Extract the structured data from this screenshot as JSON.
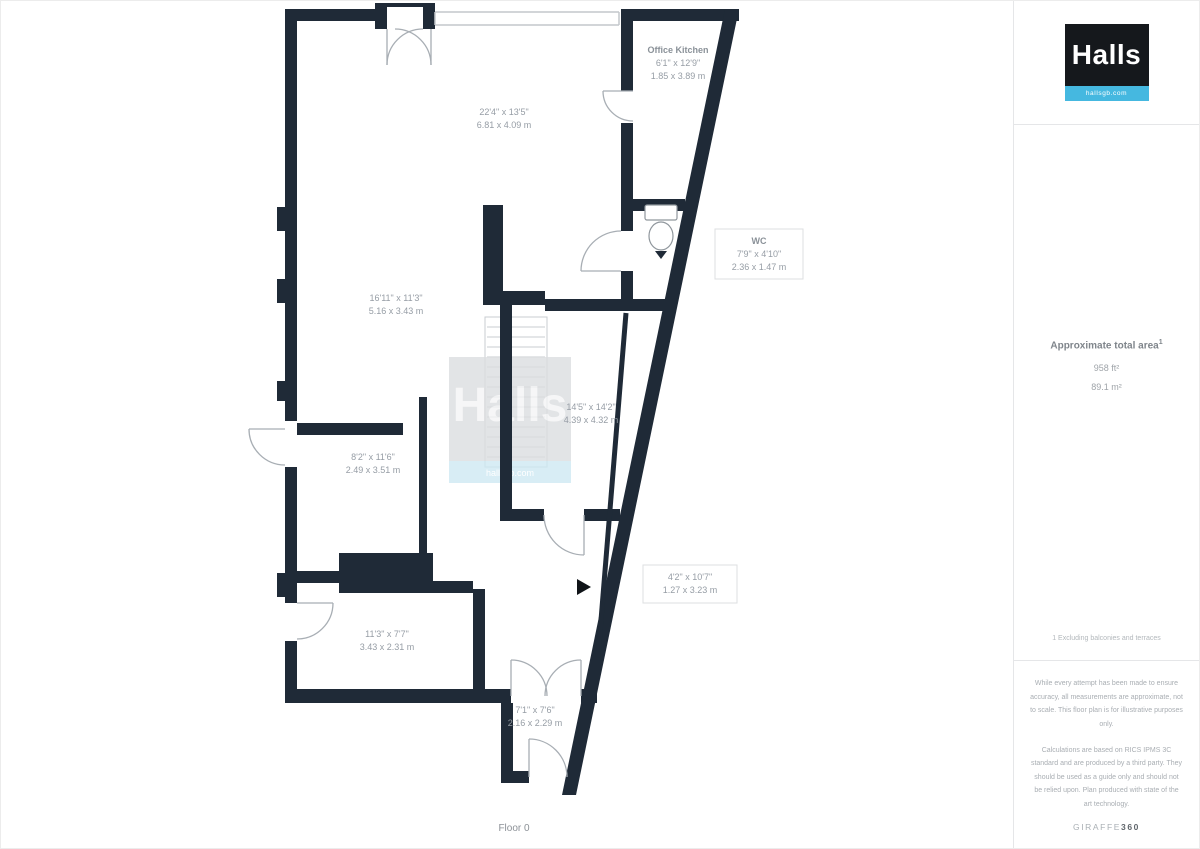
{
  "branding": {
    "logo_text": "Halls",
    "logo_tagline": "hallsgb.com"
  },
  "watermark": {
    "text": "Halls",
    "tagline": "hallsgb.com"
  },
  "plan": {
    "floor_label": "Floor 0",
    "rooms": {
      "top_middle": {
        "imperial": "22'4\" x 13'5\"",
        "metric": "6.81 x 4.09 m"
      },
      "office_kitchen": {
        "name": "Office Kitchen",
        "imperial": "6'1\" x 12'9\"",
        "metric": "1.85 x 3.89 m"
      },
      "wc": {
        "name": "WC",
        "imperial": "7'9\" x 4'10\"",
        "metric": "2.36 x 1.47 m"
      },
      "left": {
        "imperial": "16'11\" x 11'3\"",
        "metric": "5.16 x 3.43 m"
      },
      "stairwell": {
        "imperial": "14'5\" x 14'2\"",
        "metric": "4.39 x 4.32 m"
      },
      "mid_left": {
        "imperial": "8'2\" x 11'6\"",
        "metric": "2.49 x 3.51 m"
      },
      "bottom_left": {
        "imperial": "11'3\" x 7'7\"",
        "metric": "3.43 x 2.31 m"
      },
      "corridor": {
        "imperial": "4'2\" x 10'7\"",
        "metric": "1.27 x 3.23 m"
      },
      "lobby": {
        "imperial": "7'1\" x 7'6\"",
        "metric": "2.16 x 2.29 m"
      }
    }
  },
  "sidebar": {
    "area_title": "Approximate total area",
    "area_sup": "1",
    "area_ft": "958 ft²",
    "area_m": "89.1 m²",
    "footnote": "1 Excluding balconies and terraces",
    "disclaimer_1": "While every attempt has been made to ensure accuracy, all measurements are approximate, not to scale. This floor plan is for illustrative purposes only.",
    "disclaimer_2": "Calculations are based on RICS IPMS 3C standard and are produced by a third party. They should be used as a guide only and should not be relied upon. Plan produced with state of the art technology.",
    "powered_by_light": "GIRAFFE",
    "powered_by_bold": "360"
  },
  "colors": {
    "wall": "#1f2a37",
    "accent_cyan": "#45b8e0",
    "label_gray": "#969da5"
  }
}
